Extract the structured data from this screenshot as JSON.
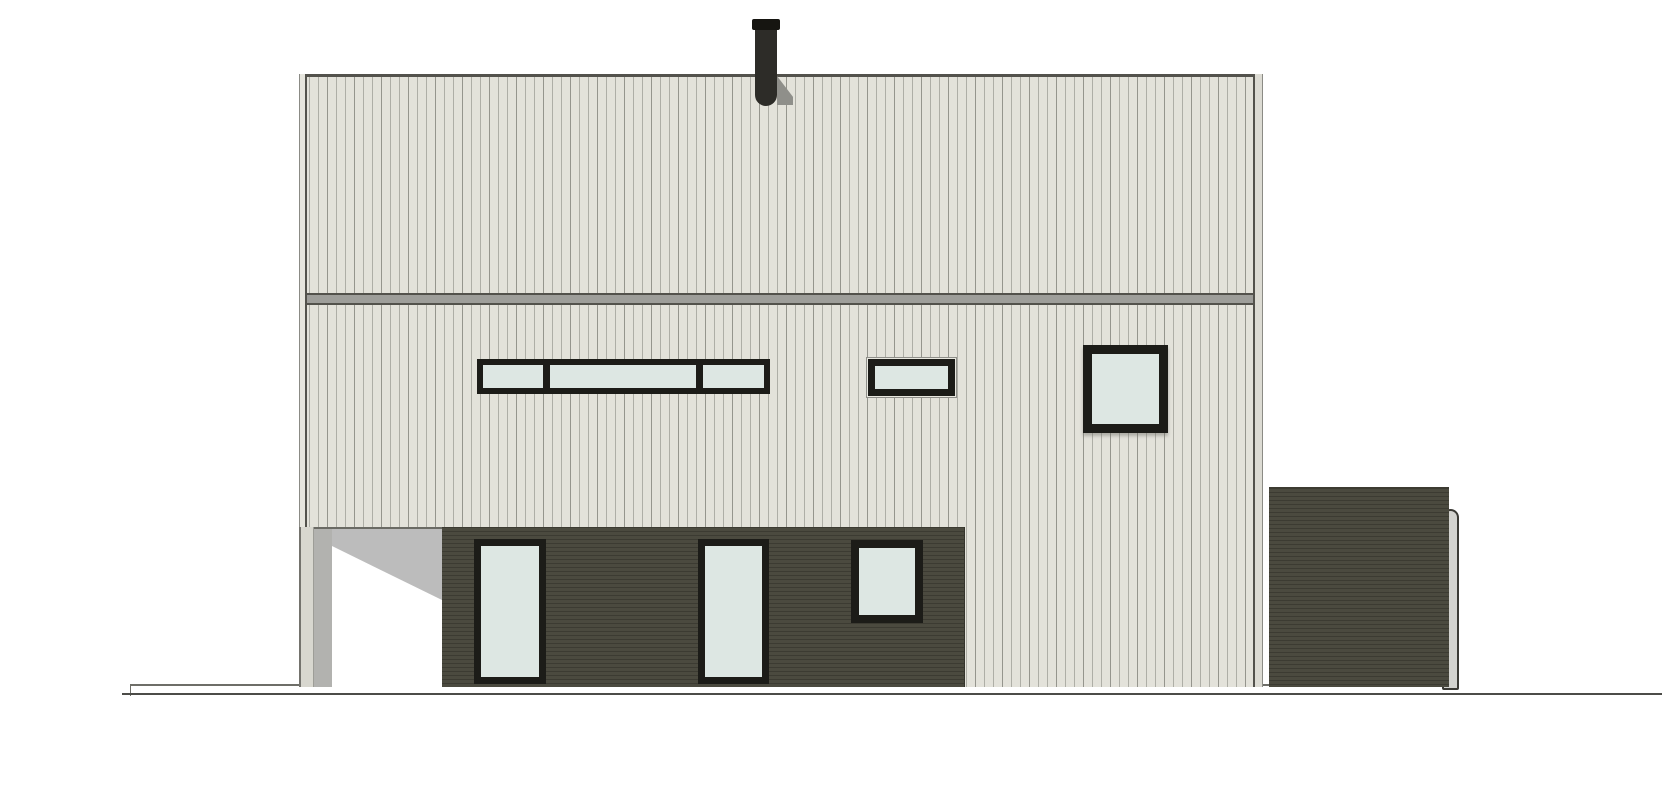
{
  "colors": {
    "background": "#ffffff",
    "siding-light": "#e3e2da",
    "siding-line": "#aeaea6",
    "siding-line-strong": "#95958d",
    "siding-dark": "#4b4a3f",
    "siding-dark-line": "#3c3b32",
    "band-gray": "#9e9e9a",
    "edge-dark": "#53524c",
    "window-frame": "#1c1c18",
    "glass": "#dde7e3",
    "shadow": "#bcbcbc",
    "column-shadow": "#b2b2af",
    "chimney-shadow": "#8f8f8a",
    "chimney": "#2d2c28",
    "chimney-cap": "#161511",
    "pipe": "#d3d3cf",
    "pipe-outline": "#3b3a35",
    "ground-line": "#4c4c48",
    "plinth-line": "#6e6e68",
    "column-fill": "#d8d7cf",
    "opening": "#ffffff"
  },
  "scene": {
    "elements": [
      "chimney",
      "upper-roof-wall",
      "belt-band",
      "ribbon-window-3-panes",
      "small-window",
      "square-window-upper",
      "carport-opening",
      "porch-column",
      "dark-cladding-section",
      "tall-window-1",
      "tall-window-2",
      "square-window-lower",
      "annex-volume",
      "downspout-pipe",
      "plinth",
      "ground-line"
    ],
    "window_counts": {
      "upper_floor": 3,
      "ground_floor": 3,
      "ribbon_panes": 3
    }
  }
}
